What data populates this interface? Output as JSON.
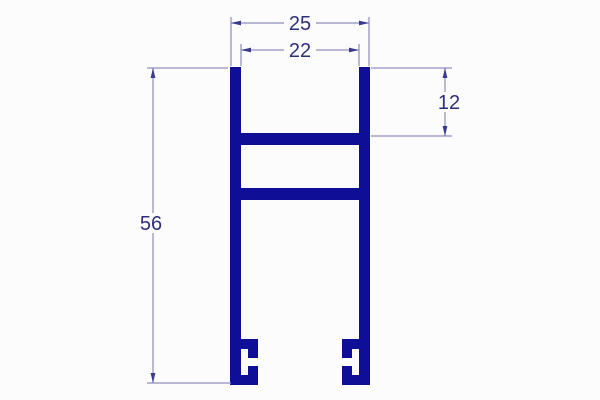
{
  "drawing": {
    "labels": {
      "outer_width": "25",
      "inner_width": "22",
      "top_channel_depth": "12",
      "overall_height": "56"
    }
  },
  "colors": {
    "profile": "#0e0e97",
    "dimension_lines": "#8f8fbb",
    "arrowheads": "#3a3a8e",
    "label_text": "#2e2e7b",
    "background": "#fcfcfc"
  }
}
